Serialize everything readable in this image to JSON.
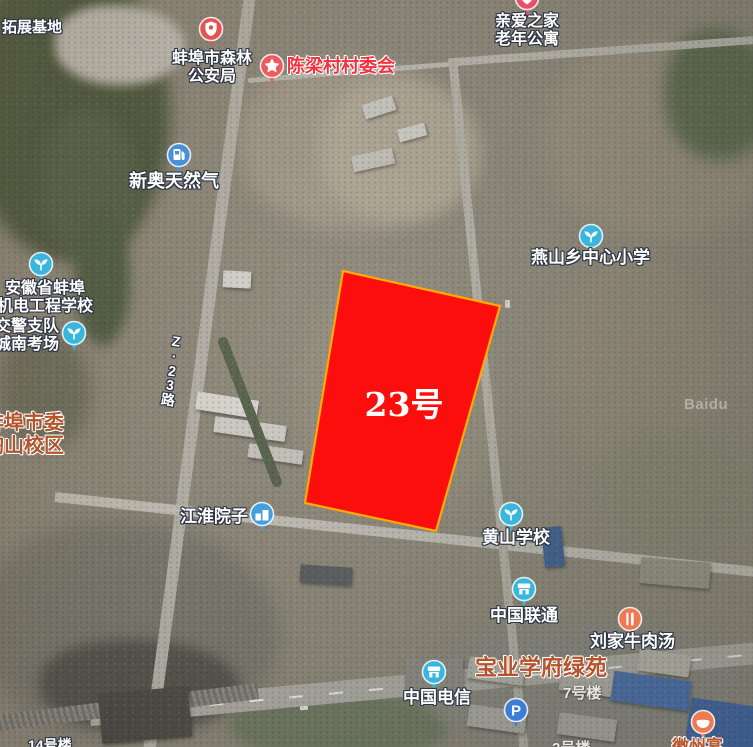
{
  "map": {
    "watermark": "Baidu",
    "parcel": {
      "label": "23号",
      "points": "343,271 500,306 436,531 305,503",
      "fill": "#fe0b0b",
      "stroke": "#ffaa00"
    },
    "colors": {
      "label_outline": "#2d3444",
      "red_label": "#f2333f",
      "brown_label": "#b4532c",
      "icon_blue": "#38b6dd",
      "icon_sky_blue": "#44a0dc",
      "icon_red": "#ee5a5e",
      "icon_coral": "#e45252",
      "icon_orange": "#ef7a52",
      "icon_dark_blue": "#3d7dd8",
      "parcel_red": "#fe0b0b",
      "parcel_border": "#ffaa00"
    },
    "poi_icons": [
      {
        "name": "police-badge-icon",
        "type": "police",
        "cx": 211,
        "cy": 29,
        "bg": "#e45252"
      },
      {
        "name": "star-icon",
        "type": "star",
        "cx": 272,
        "cy": 66,
        "bg": "#ee5a5e"
      },
      {
        "name": "heart-pin-icon",
        "type": "heart",
        "cx": 527,
        "cy": -2,
        "bg": "#e8506a"
      },
      {
        "name": "fuel-pin-icon",
        "type": "fuel",
        "cx": 179,
        "cy": 155,
        "bg": "#4a90d9"
      },
      {
        "name": "school-icon-1",
        "type": "school",
        "cx": 41,
        "cy": 264,
        "bg": "#38b6dd"
      },
      {
        "name": "school-icon-2",
        "type": "school",
        "cx": 74,
        "cy": 333,
        "bg": "#38b6dd"
      },
      {
        "name": "school-icon-3",
        "type": "school",
        "cx": 591,
        "cy": 236,
        "bg": "#38b6dd"
      },
      {
        "name": "building-pin-icon",
        "type": "building",
        "cx": 262,
        "cy": 514,
        "bg": "#44a0dc"
      },
      {
        "name": "school-icon-4",
        "type": "school",
        "cx": 511,
        "cy": 514,
        "bg": "#38b6dd"
      },
      {
        "name": "shop-icon-1",
        "type": "shop",
        "cx": 524,
        "cy": 589,
        "bg": "#38b6dd"
      },
      {
        "name": "restaurant-icon",
        "type": "food",
        "cx": 630,
        "cy": 619,
        "bg": "#ef7a52"
      },
      {
        "name": "shop-icon-2",
        "type": "shop",
        "cx": 434,
        "cy": 672,
        "bg": "#38b6dd"
      },
      {
        "name": "parking-icon",
        "type": "parking",
        "cx": 516,
        "cy": 710,
        "bg": "#3d7dd8"
      },
      {
        "name": "bowl-icon",
        "type": "bowl",
        "cx": 703,
        "cy": 722,
        "bg": "#ef7a52"
      }
    ],
    "labels": [
      {
        "name": "label-tuozhan-jidi",
        "lines": [
          "拓展基地"
        ],
        "x": 2,
        "y": 20,
        "fs": 15,
        "style": "white"
      },
      {
        "name": "label-senlin-gonganju",
        "lines": [
          "蚌埠市森林",
          "公安局"
        ],
        "cx": 212,
        "y": 50,
        "fs": 16,
        "style": "white"
      },
      {
        "name": "label-chenliangcun-cunweihui",
        "lines": [
          "陈梁村村委会"
        ],
        "x": 287,
        "y": 56,
        "fs": 18,
        "style": "red",
        "bold": true
      },
      {
        "name": "label-qinai-zhijia",
        "lines": [
          "亲爱之家",
          "老年公寓"
        ],
        "cx": 527,
        "y": 13,
        "fs": 16,
        "style": "white"
      },
      {
        "name": "label-xinao-tianranqi",
        "lines": [
          "新奥天然气"
        ],
        "x": 129,
        "y": 171,
        "fs": 18,
        "style": "white"
      },
      {
        "name": "label-jidian-gongcheng-xuexiao",
        "lines": [
          "安徽省蚌埠",
          "机电工程学校"
        ],
        "cx": 45,
        "y": 280,
        "fs": 16,
        "style": "white"
      },
      {
        "name": "label-jiaojing-zhidui",
        "lines": [
          "交警支队",
          "城南考场"
        ],
        "cx": 27,
        "y": 318,
        "fs": 16,
        "style": "white"
      },
      {
        "name": "label-road-z23",
        "lines": [
          "Z",
          "·",
          "2",
          "3",
          "路"
        ],
        "cx": 172,
        "y": 334,
        "fs": 14,
        "style": "white",
        "vertical": true,
        "rot": 8,
        "interactable": false
      },
      {
        "name": "label-shiwei-xiaoqu",
        "lines": [
          "蚌埠市委",
          "陶山校区"
        ],
        "x": -16,
        "y": 412,
        "fs": 20,
        "style": "brown",
        "bold": true
      },
      {
        "name": "label-yanshan-xiaoxue",
        "lines": [
          "燕山乡中心小学"
        ],
        "x": 531,
        "y": 248,
        "fs": 17,
        "style": "white"
      },
      {
        "name": "label-jianghuai-yuanzi",
        "lines": [
          "江淮院子"
        ],
        "x": 180,
        "y": 507,
        "fs": 17,
        "style": "white"
      },
      {
        "name": "label-huangshan-xuexiao",
        "lines": [
          "黄山学校"
        ],
        "x": 482,
        "y": 528,
        "fs": 17,
        "style": "white"
      },
      {
        "name": "label-zhongguo-liantong",
        "lines": [
          "中国联通"
        ],
        "x": 490,
        "y": 606,
        "fs": 17,
        "style": "white"
      },
      {
        "name": "label-liujia-niuroutang",
        "lines": [
          "刘家牛肉汤"
        ],
        "x": 590,
        "y": 632,
        "fs": 17,
        "style": "white"
      },
      {
        "name": "label-baoye-xuefu-lvyuan",
        "lines": [
          "宝业学府绿苑"
        ],
        "x": 475,
        "y": 656,
        "fs": 22,
        "style": "brown",
        "bold": true
      },
      {
        "name": "label-7-haolou",
        "lines": [
          "7号楼"
        ],
        "x": 563,
        "y": 686,
        "fs": 15,
        "style": "dim"
      },
      {
        "name": "label-zhongguo-dianxin",
        "lines": [
          "中国电信"
        ],
        "x": 403,
        "y": 688,
        "fs": 17,
        "style": "white"
      },
      {
        "name": "label-huizhouyan",
        "lines": [
          "徽州宴"
        ],
        "x": 672,
        "y": 737,
        "fs": 17,
        "style": "brown"
      },
      {
        "name": "label-14-haolou",
        "lines": [
          "14号楼"
        ],
        "x": 28,
        "y": 738,
        "fs": 14,
        "style": "white"
      },
      {
        "name": "label-2-haolou",
        "lines": [
          "2号楼"
        ],
        "x": 552,
        "y": 741,
        "fs": 15,
        "style": "dim"
      }
    ]
  }
}
